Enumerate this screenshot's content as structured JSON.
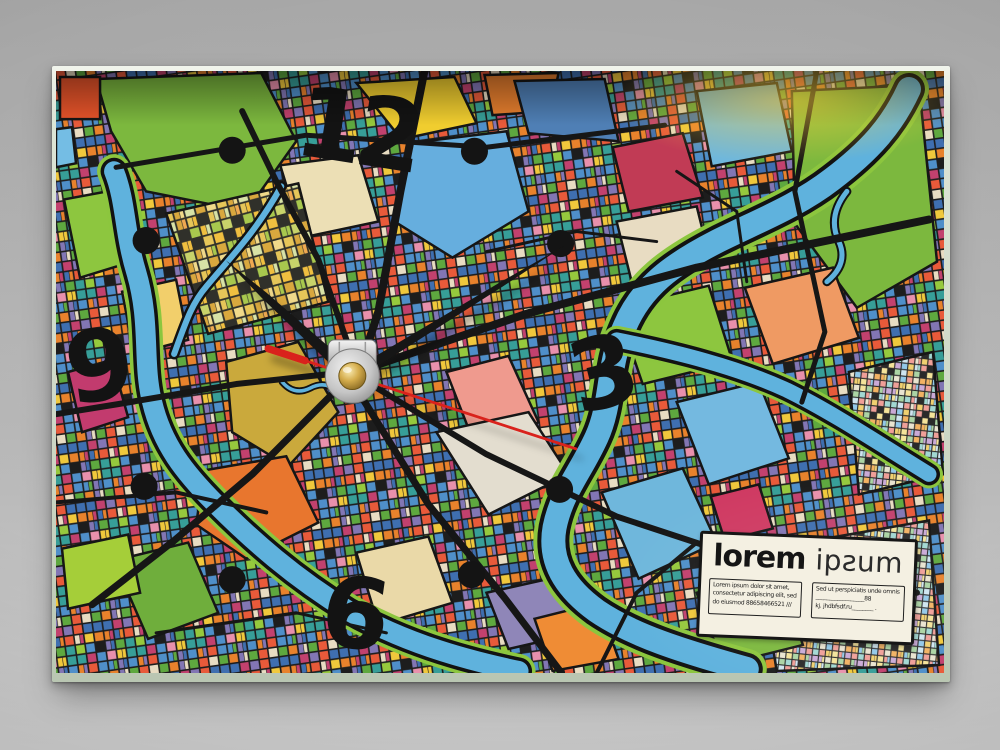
{
  "scene": {
    "type": "product photograph",
    "subject": "rectangular glass table clock printed with an abstract multicolor city map",
    "backdrop_color": "#b2b2b2"
  },
  "clock": {
    "numerals": {
      "twelve": "12",
      "three": "3",
      "six": "6",
      "nine": "9"
    },
    "hour_markers": "black dots at 1,2,4,5,7,8,10,11",
    "time_reading": "approx 10:09:18",
    "hands": {
      "hour_transform": "rotate(-47.6 296 304)",
      "minute_transform": "rotate(58.5 296 304)",
      "second_transform": "rotate(108 296 304)",
      "hand_color": "#161513",
      "second_hand_color": "#d9201b"
    },
    "colors": {
      "numeral_color": "#131313",
      "river": "#5fb2dd",
      "river_bank_green": "#8cc63e",
      "road": "#161616",
      "hub_silver": "#cbcbcb",
      "hub_brass": "#c29a3f",
      "glass_edge": "#dfe7d8"
    }
  },
  "label": {
    "brand_bold": "lorem",
    "brand_light": "ipƨum",
    "left_box_lines": [
      "Lorem ipsum dolor sit amet,",
      "consectetur adipiscing elit, sed",
      "do eiusmod 88658466521 ///"
    ],
    "right_box_lines": [
      "Sed ut perspiciatis unde omnis",
      "__________________88",
      "kj. jhdbfsdf.ru________ ."
    ]
  },
  "map": {
    "palette_bright": [
      "#cf4436",
      "#e8822c",
      "#f0c83c",
      "#4f8fc9",
      "#74bde4",
      "#5ea83f",
      "#96c93d",
      "#c2416e",
      "#e890ac",
      "#379e98",
      "#e8dcc2",
      "#8276b4",
      "#e85a3a",
      "#3f6fb0"
    ],
    "palette_pastel": [
      "#92c8e8",
      "#f0d070",
      "#ef9f98",
      "#abd4a4",
      "#e9e4d0",
      "#caaad6",
      "#f2b263",
      "#a2d8d2",
      "#e890a8",
      "#cfe5f0",
      "#f4e39a"
    ],
    "palette_warm": [
      "#f0d98a",
      "#e6c659",
      "#d8e2a6",
      "#efa951",
      "#e9dcc0",
      "#c8d36a",
      "#f0bf40",
      "#d9a83e",
      "#a8c84e"
    ]
  }
}
